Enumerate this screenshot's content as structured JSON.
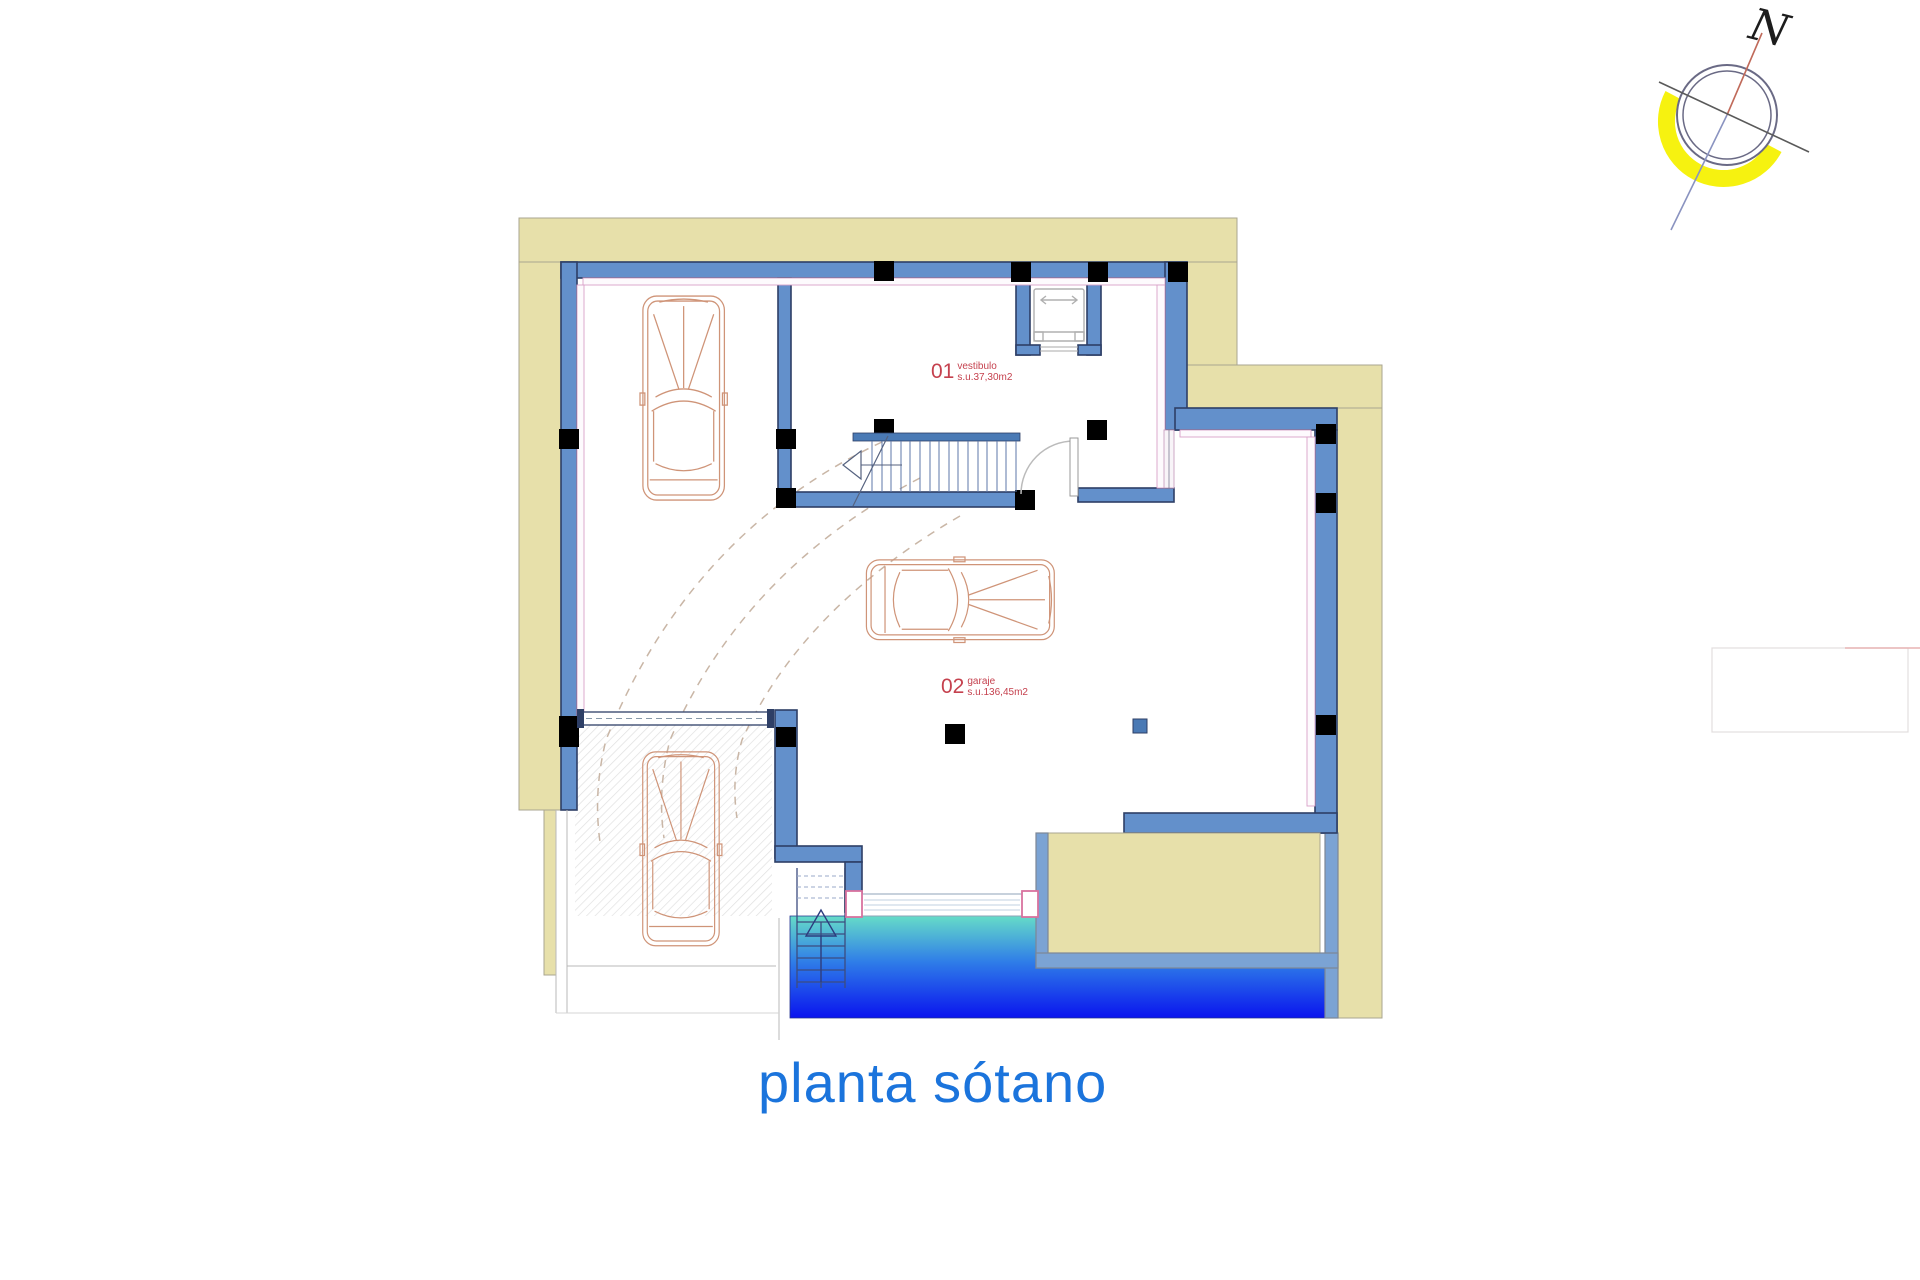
{
  "title": {
    "text": "planta sótano"
  },
  "compass": {
    "label": "N"
  },
  "rooms": [
    {
      "number": "01",
      "name": "vestibulo",
      "area": "s.u.37,30m2"
    },
    {
      "number": "02",
      "name": "garaje",
      "area": "s.u.136,45m2"
    }
  ],
  "colors": {
    "tan": "#e7e0aa",
    "tan_edge": "#aaa690",
    "wall_blue": "#6390cb",
    "wall_edge": "#2e3f66",
    "light_wall": "#7ba3d4",
    "lining_pink": "#d9a0c8",
    "pillar_pink": "#e071a8",
    "pillar_purple": "#6f5fa8",
    "car_salmon": "#cf9478",
    "arc_tan": "#c9b6a6",
    "pool_top": "#66dcc8",
    "pool_mid": "#2f7de8",
    "pool_deep": "#0a14ee",
    "title_blue": "#1b74dc",
    "label_red": "#c5414e",
    "compass_yellow": "#f6f210",
    "elevator_gray": "#b0b0b0"
  }
}
